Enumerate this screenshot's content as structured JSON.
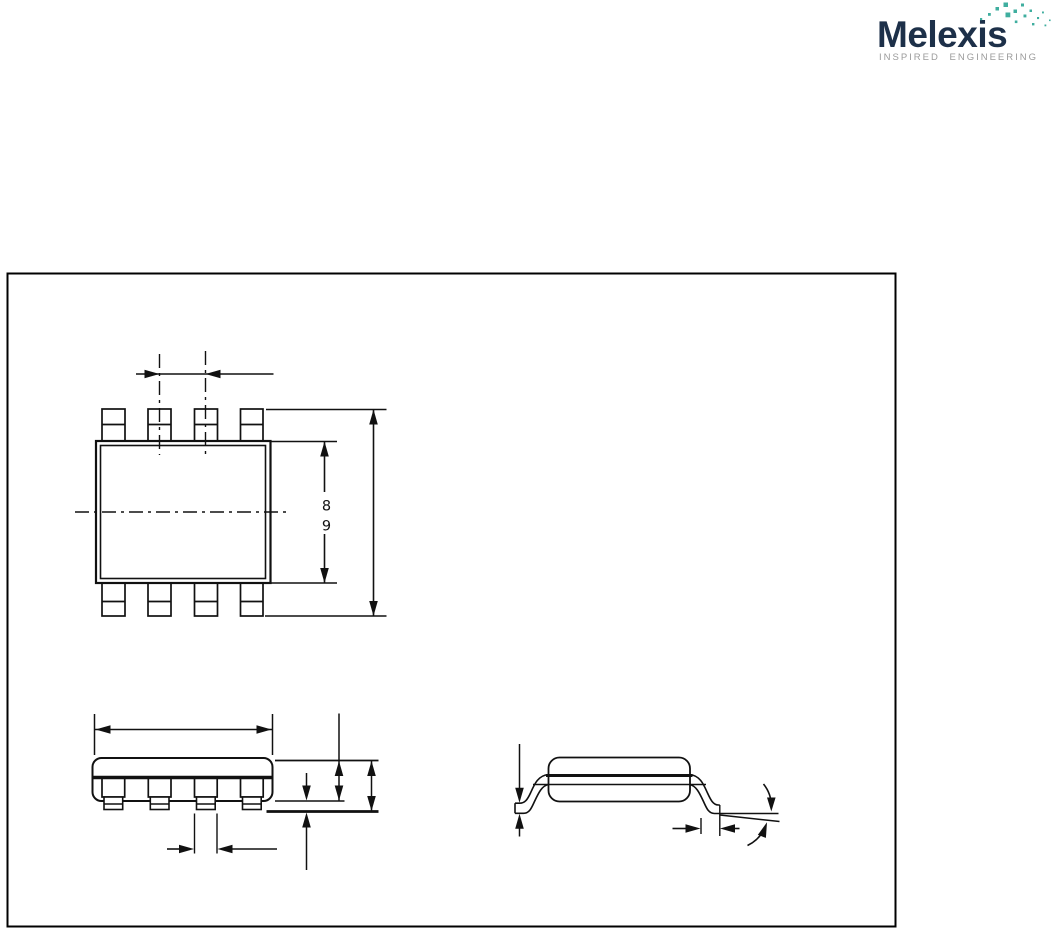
{
  "logo": {
    "brand": "Melexis",
    "tagline": "INSPIRED ENGINEERING",
    "brand_color": "#1d3049",
    "tagline_color": "#9b9b9b",
    "accent_color": "#3fae9f"
  },
  "figure": {
    "description": "package-outline-drawing",
    "frame_color": "#000000",
    "line_color": "#111111",
    "callouts": {
      "ref8": "8",
      "ref9": "9"
    }
  }
}
